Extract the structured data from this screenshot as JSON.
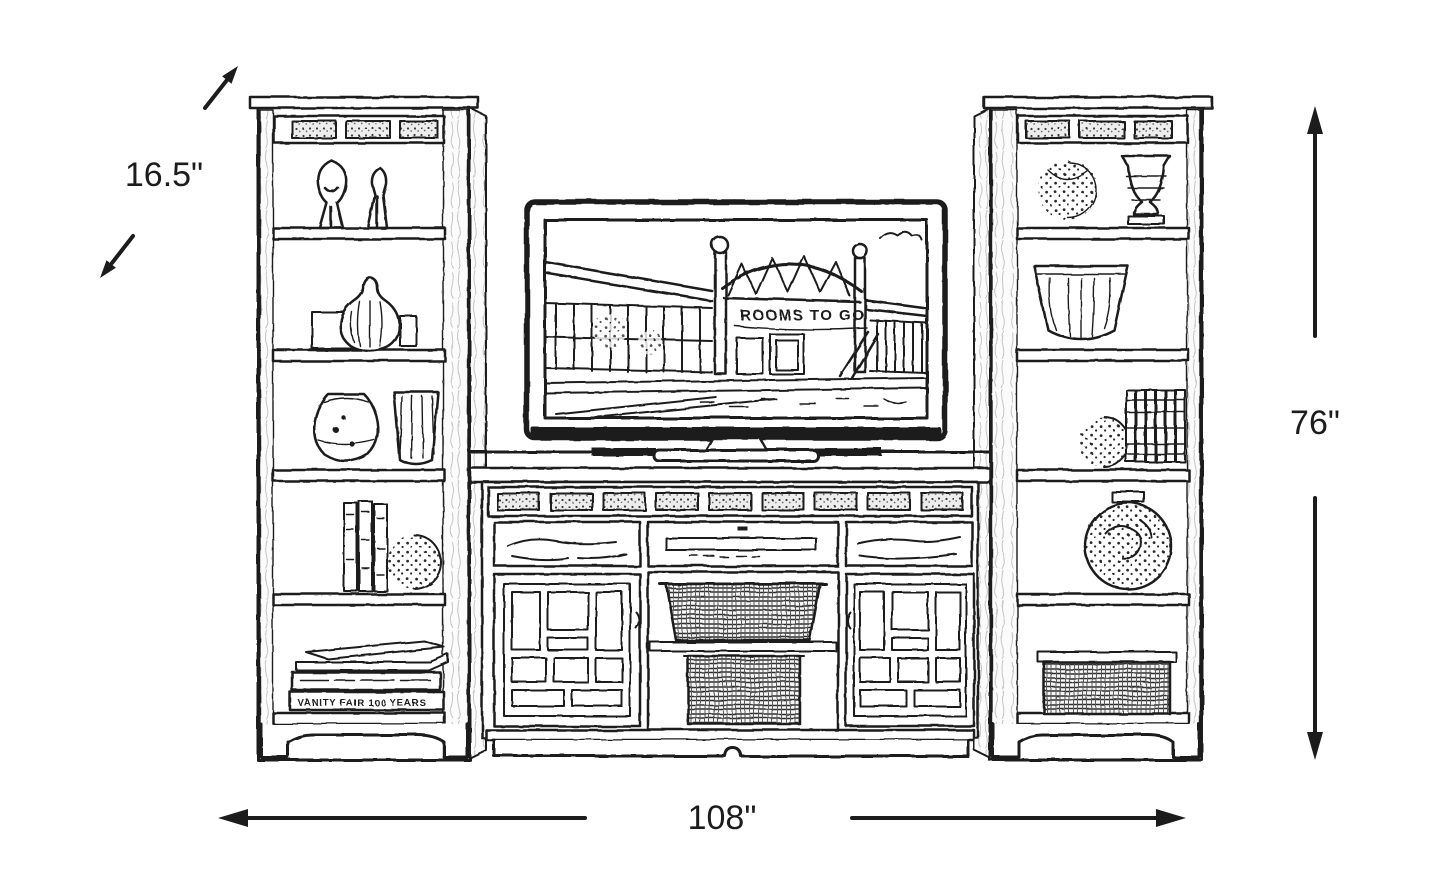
{
  "canvas": {
    "background": "#ffffff",
    "ink_color": "#1c1c1c"
  },
  "diagram": {
    "dimensions": {
      "depth": {
        "label": "16.5\"",
        "inches": 16.5,
        "axis": "diagonal-depth"
      },
      "height": {
        "label": "76\"",
        "inches": 76,
        "axis": "vertical-height"
      },
      "width": {
        "label": "108\"",
        "inches": 108,
        "axis": "horizontal-width"
      }
    },
    "tv": {
      "screen_sign_text": "ROOMS TO GO"
    },
    "left_pier": {
      "book_spine_text": "VANITY FAIR 100 YEARS"
    }
  }
}
